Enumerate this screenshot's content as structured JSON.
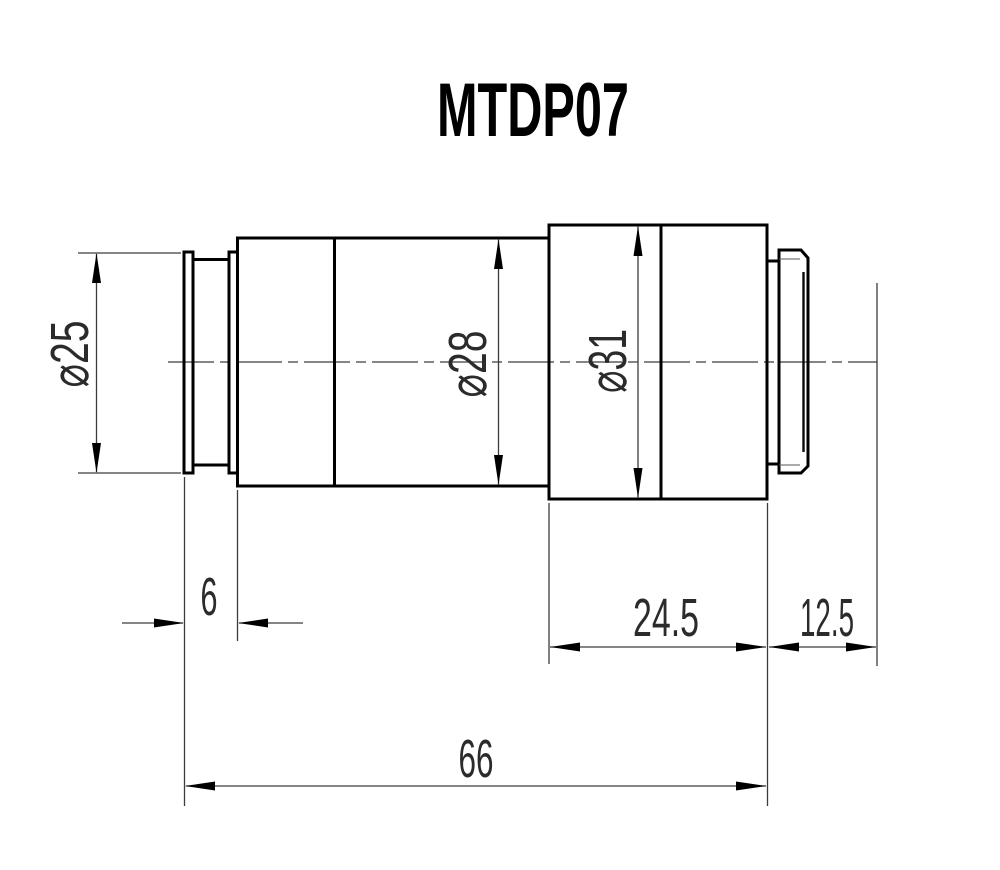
{
  "title": "MTDP07",
  "dims": {
    "dia25": "⌀25",
    "dia28": "⌀28",
    "dia31": "⌀31",
    "len6": "6",
    "len245": "24.5",
    "len125": "12.5",
    "len66": "66"
  }
}
